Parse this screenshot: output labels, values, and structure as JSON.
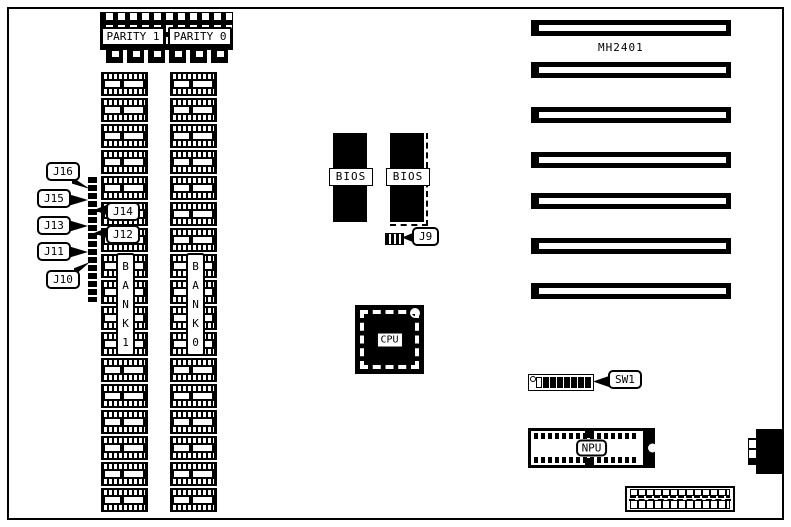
{
  "colors": {
    "ink": "#000000",
    "paper": "#ffffff"
  },
  "board": {
    "model_label": "MH2401",
    "parity_chips": [
      {
        "label": "PARITY 1"
      },
      {
        "label": "PARITY 0"
      }
    ],
    "memory_columns": [
      {
        "bank_label": "B\nA\nN\nK\n1",
        "chips": 17
      },
      {
        "bank_label": "B\nA\nN\nK\n0",
        "chips": 17
      }
    ],
    "jumper_callouts": {
      "j16": "J16",
      "j15": "J15",
      "j14": "J14",
      "j13": "J13",
      "j12": "J12",
      "j11": "J11",
      "j10": "J10",
      "j9": "J9"
    },
    "bios_chips": [
      {
        "label": "BIOS"
      },
      {
        "label": "BIOS"
      }
    ],
    "cpu": {
      "label": "CPU"
    },
    "npu": {
      "label": "NPU"
    },
    "dip_switch": {
      "label": "SW1",
      "positions": [
        "open",
        "closed",
        "closed",
        "closed",
        "closed",
        "closed",
        "closed",
        "closed"
      ]
    },
    "expansion_slots": {
      "count": 7,
      "tops": [
        20,
        62,
        107,
        152,
        193,
        238,
        283
      ]
    }
  }
}
